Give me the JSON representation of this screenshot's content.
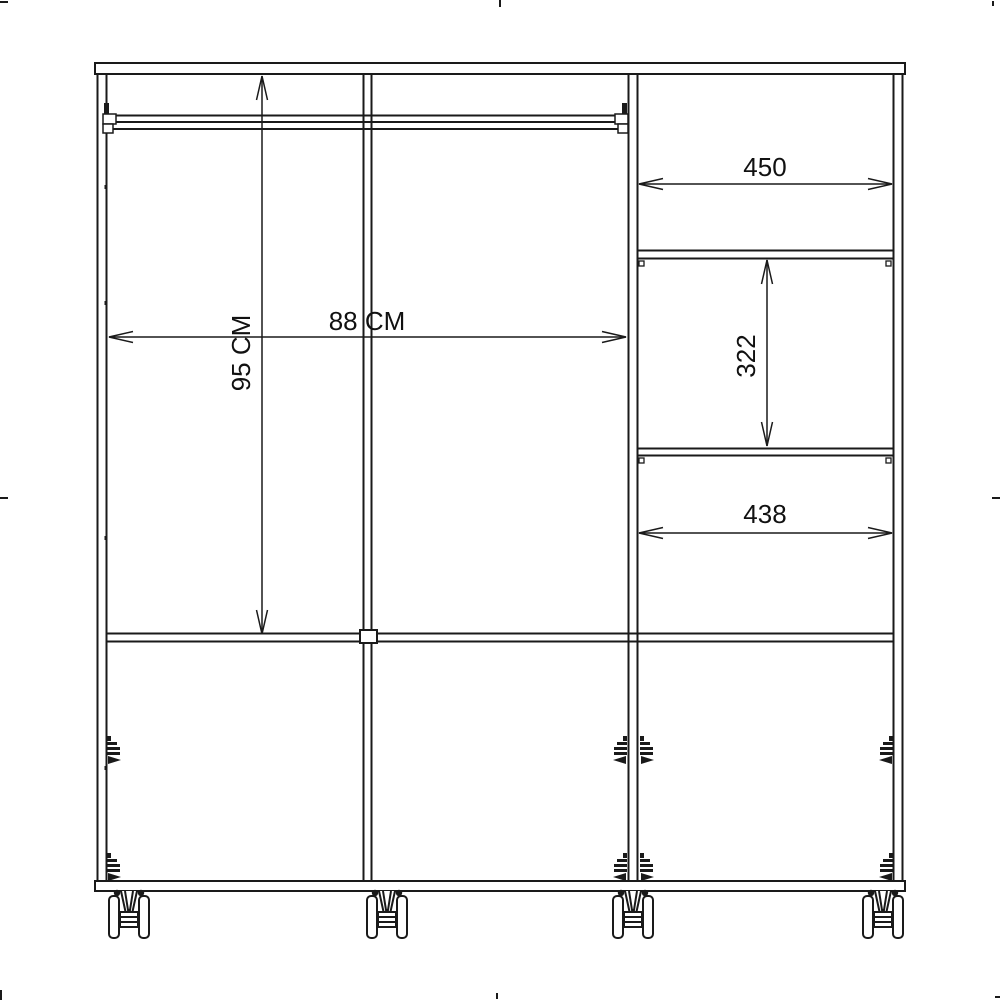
{
  "drawing": {
    "kind": "wardrobe-front-section-technical-drawing",
    "dims": {
      "interior_width_label": "88 CM",
      "interior_height_label": "95 CM",
      "top_shelf_width_label": "450",
      "middle_compartment_height_label": "322",
      "lower_shelf_width_label": "438"
    }
  },
  "colors": {
    "line": "#1a1a1a",
    "text": "#111111",
    "background": "#ffffff"
  }
}
